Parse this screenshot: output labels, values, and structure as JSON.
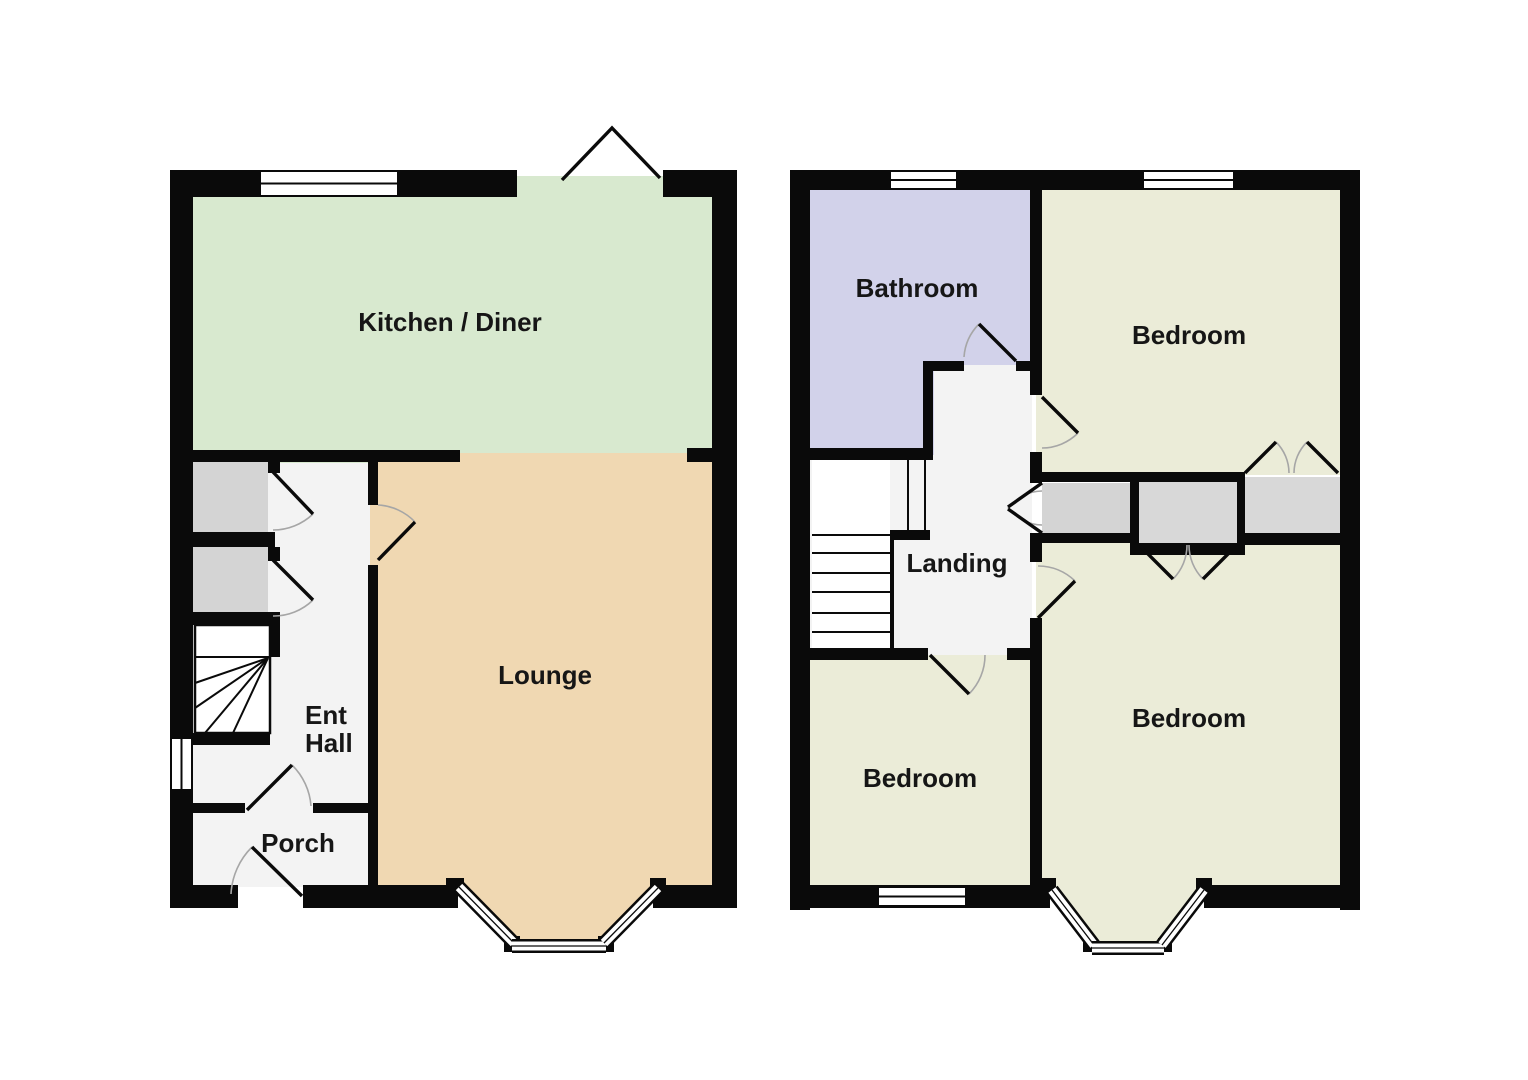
{
  "document": {
    "type": "floor-plan",
    "floors": 2
  },
  "colors": {
    "wall": "#0a0a0a",
    "kitchen": "#d8e9cf",
    "lounge": "#f0d8b2",
    "bedroom": "#ebecd8",
    "bathroom": "#d2d2ea",
    "hall": "#f3f3f3",
    "storage": "#d4d4d4",
    "wardrobe": "#d8d8d8",
    "stairs": "#ffffff",
    "door_arc": "#a6a6a6",
    "background": "#ffffff"
  },
  "ground_floor": {
    "rooms": {
      "kitchen_diner": "Kitchen / Diner",
      "lounge": "Lounge",
      "ent_hall": {
        "line1": "Ent",
        "line2": "Hall"
      },
      "porch": "Porch"
    }
  },
  "first_floor": {
    "rooms": {
      "bathroom": "Bathroom",
      "bedroom_top": "Bedroom",
      "bedroom_bottom_left": "Bedroom",
      "bedroom_bottom_right": "Bedroom",
      "landing": "Landing"
    }
  }
}
